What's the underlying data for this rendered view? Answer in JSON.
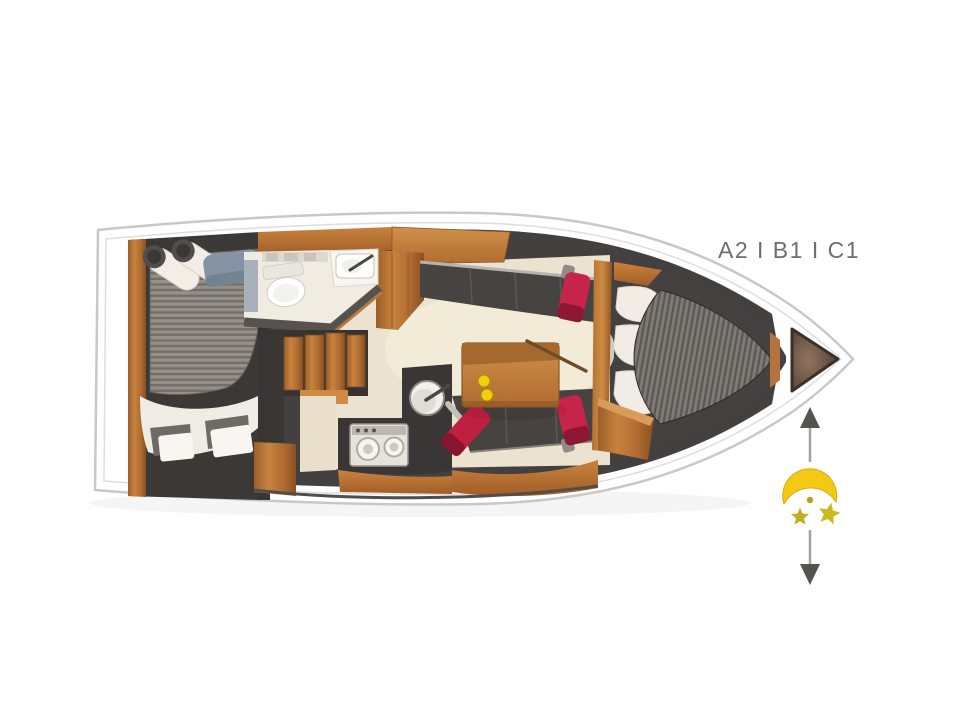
{
  "diagram": {
    "type": "yacht-interior-floorplan",
    "layout_code": "A2 I B1 I C1",
    "night_marker": {
      "icon": "crescent-moon-with-stars",
      "arrows": "double-vertical-arrow"
    },
    "colors": {
      "background": "#ffffff",
      "hull_outline": "#c8c8c8",
      "interior_dark": "#454140",
      "wood": "#c07c3b",
      "floor_cream": "#ebe2cf",
      "mattress_gray": "#8a8680",
      "cushion_white": "#f1ede5",
      "accent_red": "#c6244a",
      "moon_yellow": "#f3c915",
      "star_yellow": "#c0af20",
      "table_dot_yellow": "#f0d00c",
      "label_gray": "#6e6e6e"
    }
  }
}
